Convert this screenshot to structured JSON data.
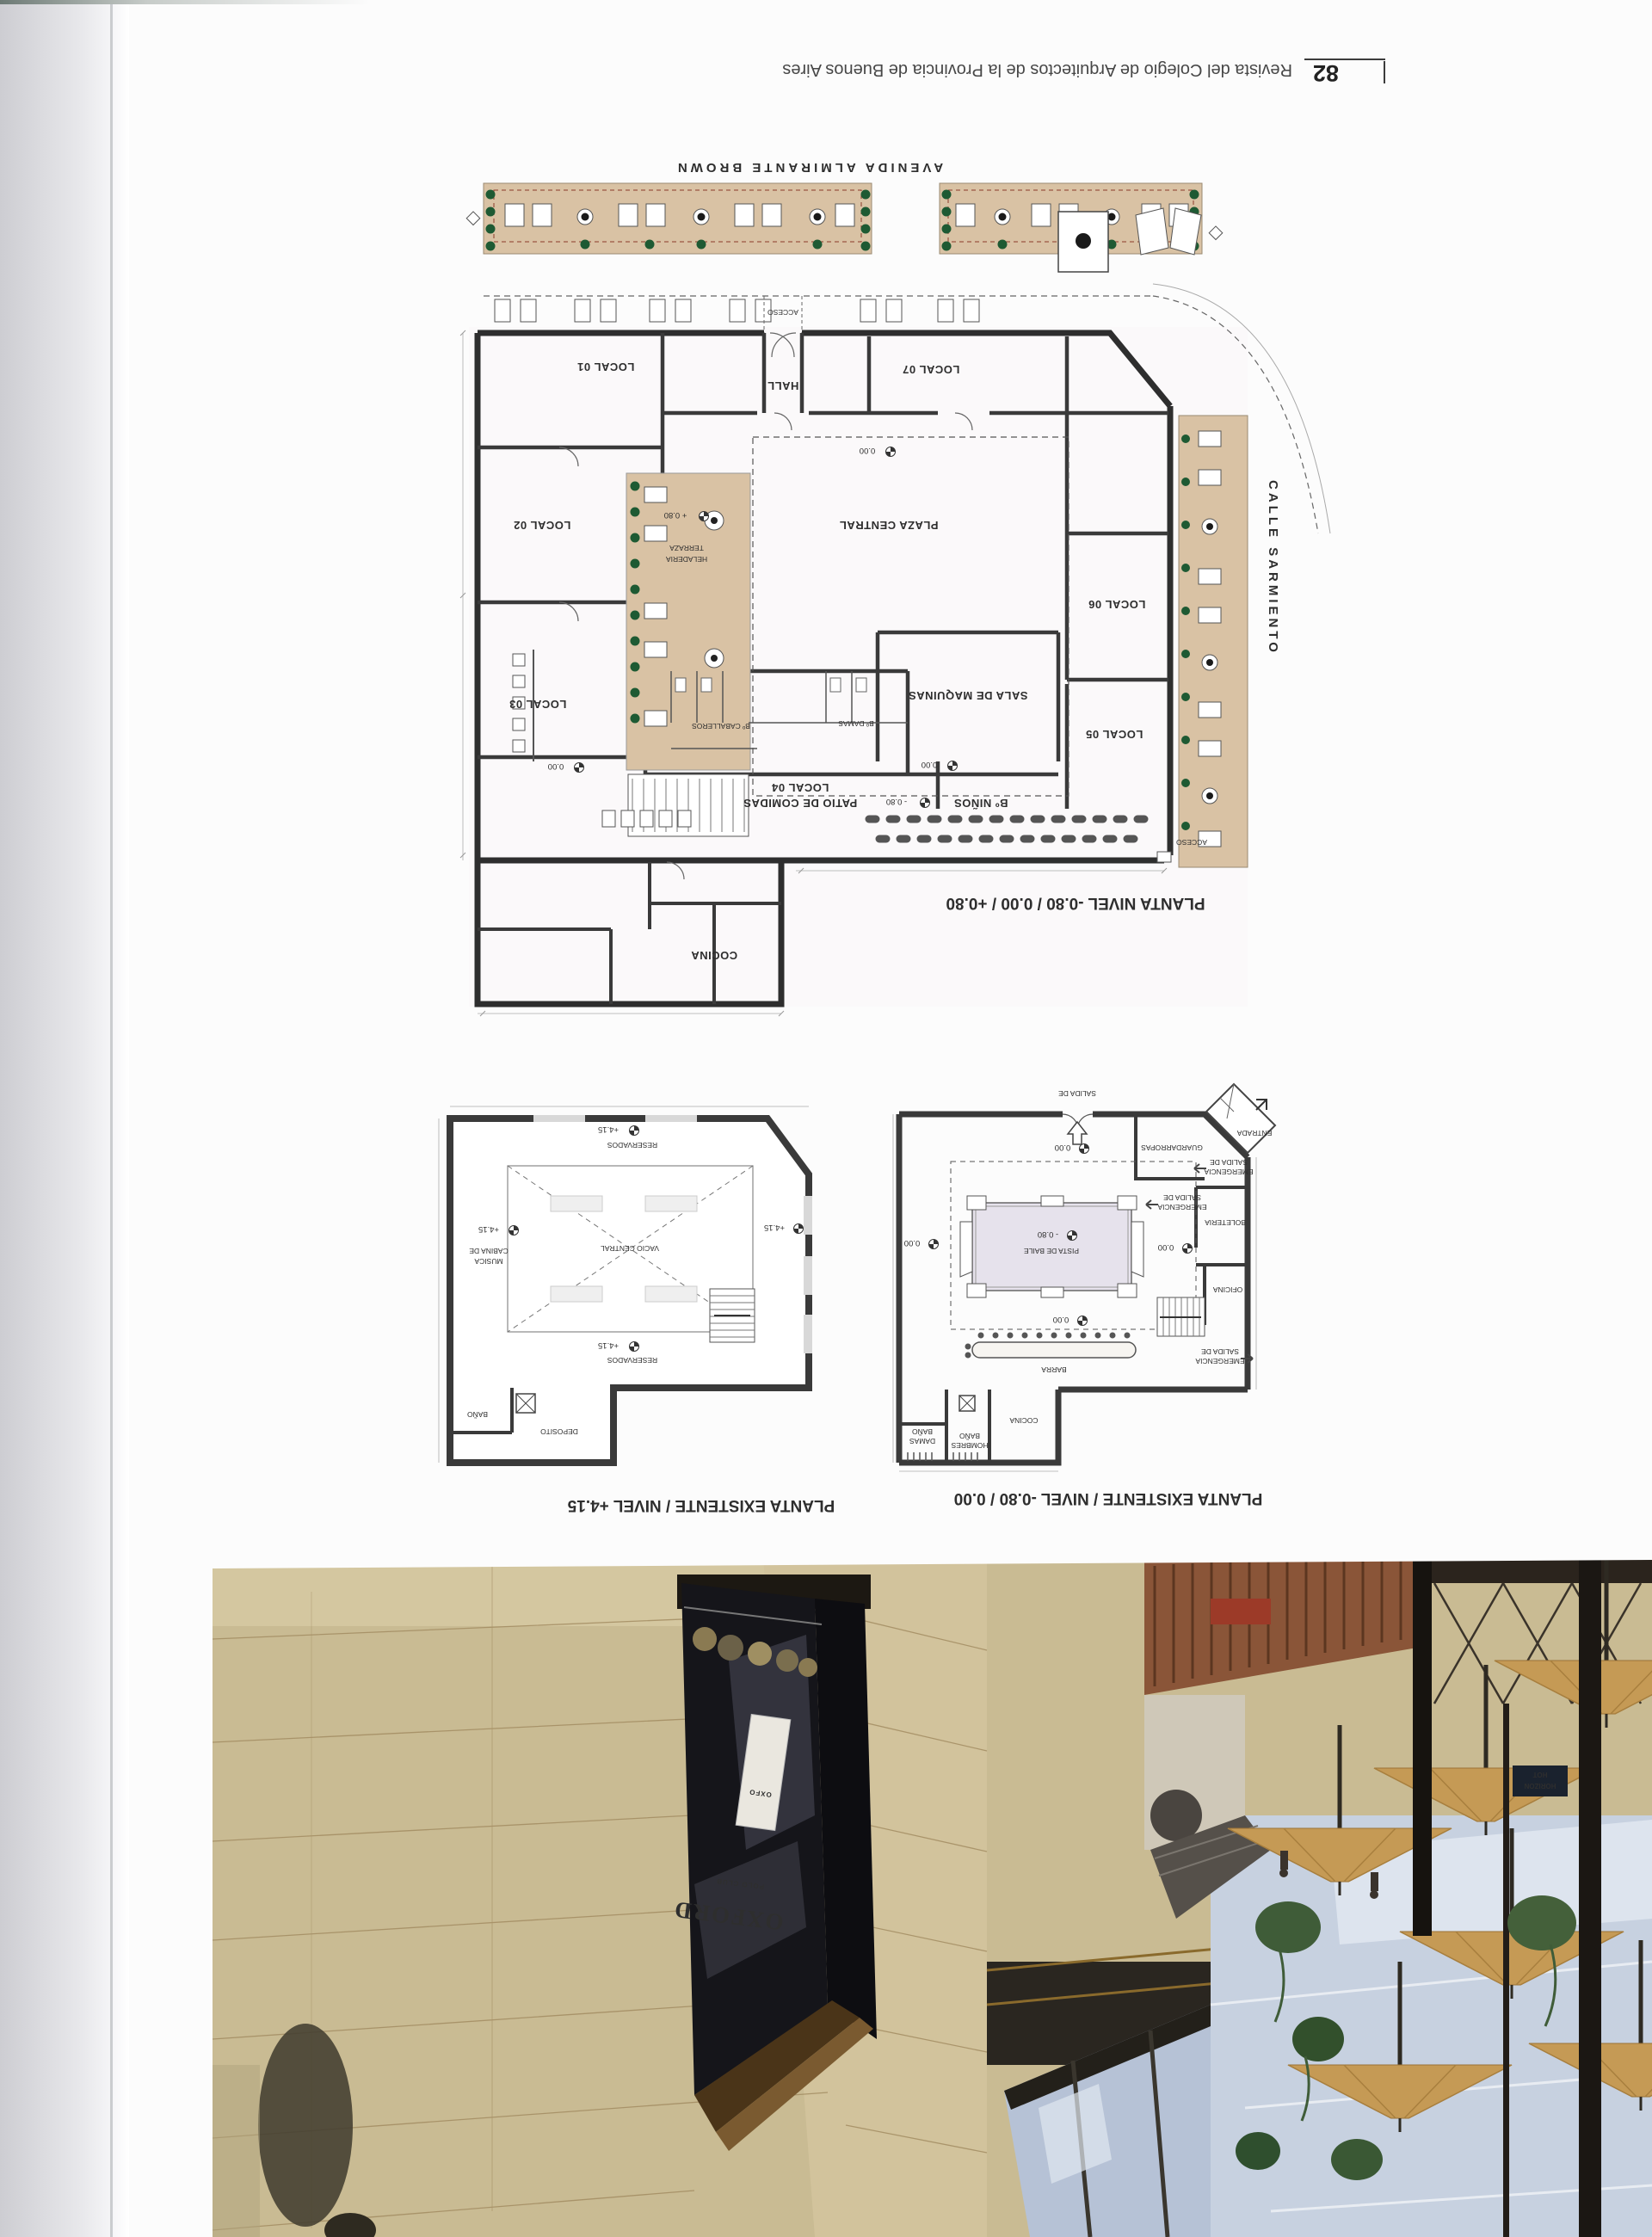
{
  "footer": {
    "page_number": "82",
    "title": "Revista del Colegio de Arquitectos de la Provincia de Buenos Aires"
  },
  "plan_main": {
    "caption": "PLANTA NIVEL -0.80 / 0.00 / +0.80",
    "street_top": "AVENIDA ALMIRANTE BROWN",
    "street_right": "CALLE SARMIENTO",
    "acceso": "ACCESO",
    "rooms": {
      "local01": "LOCAL 01",
      "local02": "LOCAL 02",
      "local03": "LOCAL 03",
      "local04": "LOCAL 04",
      "local04_sub": "PATIO DE COMIDAS",
      "local05": "LOCAL 05",
      "local06": "LOCAL 06",
      "local07": "LOCAL 07",
      "hall": "HALL",
      "plaza": "PLAZA CENTRAL",
      "terraza_1": "TERRAZA",
      "terraza_2": "HELADERIA",
      "sala_maquinas": "SALA DE MAQUINAS",
      "bano_ninos": "Bº NIÑOS",
      "bano_damas": "Bº DAMAS",
      "bano_caballeros": "Bº CABALLEROS",
      "cocina": "COCINA"
    },
    "levels": {
      "zero": "0.00",
      "plus080": "+ 0.80",
      "minus080": "- 0.80"
    }
  },
  "plan_upper": {
    "caption": "PLANTA EXISTENTE / NIVEL +4.15",
    "reservados": "RESERVADOS",
    "vacio": "VACIO CENTRAL",
    "cabina_1": "CABINA DE",
    "cabina_2": "MUSICA",
    "bano": "BAÑO",
    "deposito": "DEPOSITO",
    "level": "+4.15"
  },
  "plan_ground": {
    "caption": "PLANTA EXISTENTE / NIVEL -0.80 / 0.00",
    "salida_de": "SALIDA DE",
    "guardarropas": "GUARDARROPAS",
    "entrada": "ENTRADA",
    "salida_1": "SALIDA DE",
    "salida_2": "EMERGENCIA",
    "boleteria": "BOLETERIA",
    "pista": "PISTA DE BAILE",
    "oficina": "OFICINA",
    "barra": "BARRA",
    "cocina": "COCINA",
    "bano_damas_1": "BAÑO",
    "bano_damas_2": "DAMAS",
    "bano_hombres_1": "BAÑO",
    "bano_hombres_2": "HOMBRES",
    "level_zero": "0.00",
    "level_minus": "- 0.80"
  },
  "photo": {
    "storefront": "OXFORD",
    "storefront_sub": "POLO CLUB",
    "poster": "OXFO",
    "sign_1": "HORIZON",
    "sign_2": "HOT"
  },
  "colors": {
    "terrace": "#d9c2a4",
    "plan_wall": "#2e2e2e",
    "photo_wall": "#c9bb93",
    "sky": "#c7d1e0",
    "umbrella": "#c59a55",
    "pista": "#e6e2ec"
  }
}
